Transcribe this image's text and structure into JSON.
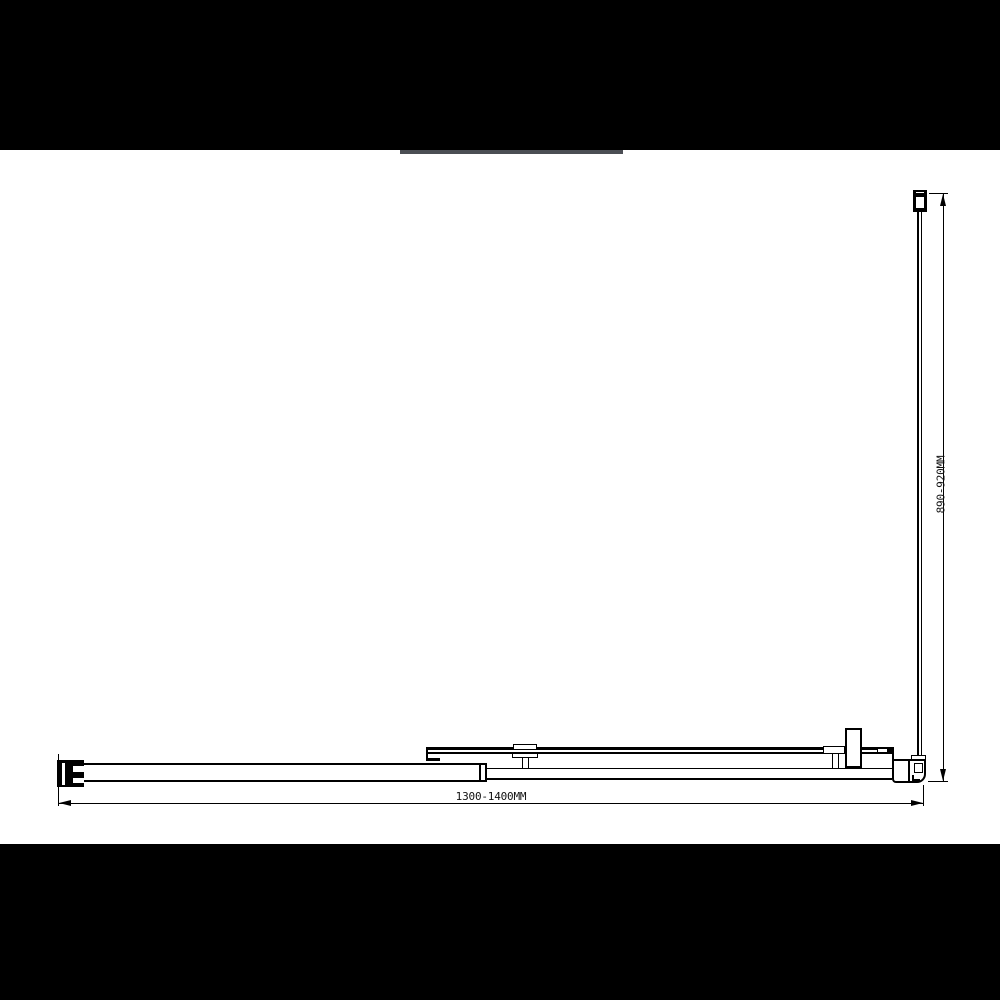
{
  "canvas": {
    "background_color": "#ffffff",
    "line_color": "#000000"
  },
  "masks": {
    "top_bar_color": "#000000",
    "bottom_bar_color": "#000000",
    "shadow_strip_color": "#4b4e54"
  },
  "drawing": {
    "type": "technical-plan-diagram",
    "subject": "corner shower enclosure plan view with sliding door and fixed return panel",
    "dimensions": {
      "width_label": "1300-1400MM",
      "depth_label": "890-920MM"
    }
  }
}
